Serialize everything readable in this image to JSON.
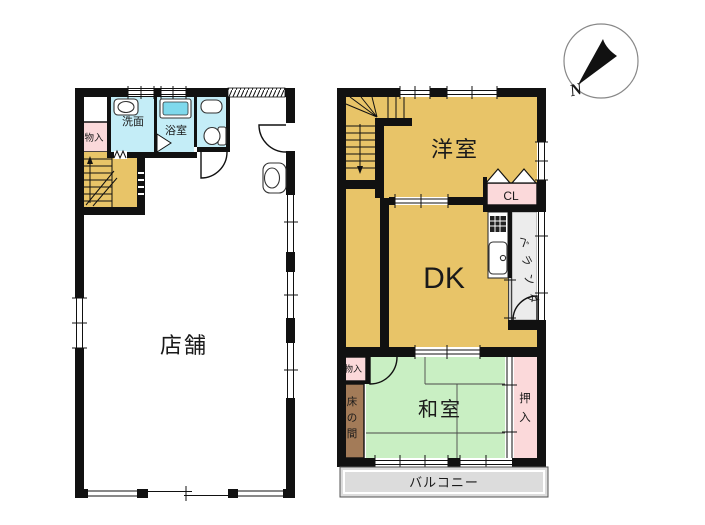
{
  "compass": {
    "north_label": "N"
  },
  "colors": {
    "wall": "#111111",
    "floor_tan": "#e8c468",
    "tatami_green": "#c9efc3",
    "pink": "#fbd9da",
    "wet_cyan": "#c4edf7",
    "tub_cyan": "#7fd9ec",
    "tokonoma_brown": "#a37b58",
    "balcony_gray": "#dcdcdc",
    "veranda_gray": "#ececec",
    "stove_dark": "#222222"
  },
  "floor1": {
    "shop": "店舗",
    "washroom": "洗面",
    "bathroom": "浴室",
    "storage": "物入"
  },
  "floor2": {
    "western_room": "洋室",
    "closet": "CL",
    "dining_kitchen": "DK",
    "storage": "物入",
    "japanese_room": "和室",
    "balcony": "バルコニー",
    "veranda_chars": [
      "ベ",
      "ラ",
      "ン",
      "ダ"
    ],
    "tokonoma_chars": [
      "床",
      "の",
      "間"
    ],
    "oshiire_chars": [
      "押",
      "入"
    ]
  }
}
